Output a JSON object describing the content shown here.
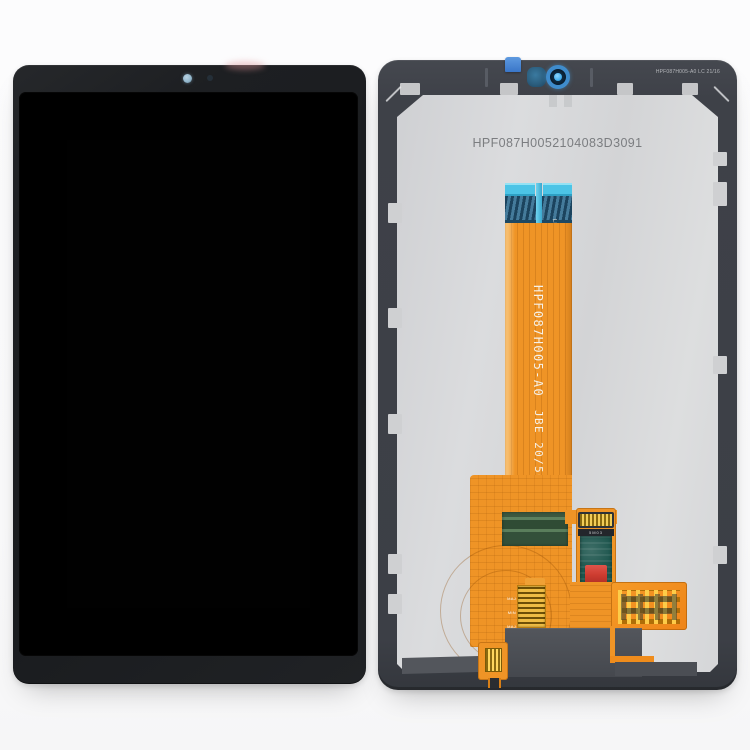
{
  "front": {
    "camera_dot_color": "#93b7cc",
    "bezel_color": "#1d1f22",
    "screen_color": "#010101"
  },
  "back": {
    "serial": "HPF087H0052104083D3091",
    "corner_label": "HPF087H005-A0 LC 21/16",
    "flex": {
      "part_number": "HPF087H005-A0",
      "batch_code": "JBE 20/50",
      "mark_left": "RCT",
      "mark_right": "LK JB",
      "connector_mark": "5M03",
      "pad_labels": [
        "MAJ",
        "MIN",
        "MAJ"
      ]
    },
    "colors": {
      "flex_orange": "#ef9426",
      "tape_cyan": "#4cc4e6",
      "connector_blue": "#2d5f80",
      "stiffener_green": "#35523b",
      "pcb_teal": "#1e564e",
      "component_red": "#cd3c30",
      "gold_pads": "#f2cd58",
      "plate_gray": "#d6d7d9",
      "frame_gray": "#3f424a"
    }
  }
}
